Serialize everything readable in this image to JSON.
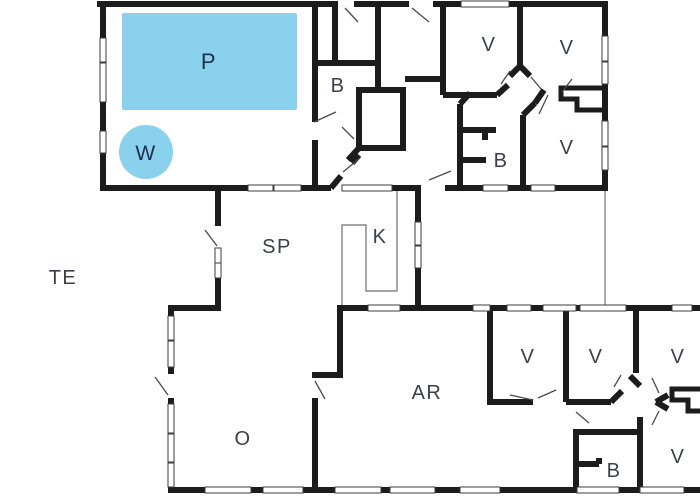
{
  "plan": {
    "title": "Holiday house floor plan",
    "background": "#ffffff",
    "wall_color": "#1c1c1c",
    "window_stroke": "#3c3c3c",
    "door_stroke": "#4a4a4a",
    "thin_stroke": "#6f6f6f",
    "pool_color": "#8ad1ee",
    "label_color": "#3a3f4a",
    "pool_label_color": "#203050"
  },
  "rooms": [
    {
      "id": "pool",
      "label": "P",
      "x": 209,
      "y": 69,
      "size": 22,
      "color_key": "pool_label_color"
    },
    {
      "id": "whirlpool",
      "label": "W",
      "x": 146,
      "y": 160,
      "size": 21,
      "color_key": "pool_label_color"
    },
    {
      "id": "bathroom-top",
      "label": "B",
      "x": 338,
      "y": 92,
      "size": 20
    },
    {
      "id": "bedroom-1",
      "label": "V",
      "x": 489,
      "y": 51,
      "size": 20
    },
    {
      "id": "bedroom-2",
      "label": "V",
      "x": 567,
      "y": 54,
      "size": 20
    },
    {
      "id": "bathroom-east",
      "label": "B",
      "x": 501,
      "y": 167,
      "size": 20
    },
    {
      "id": "bedroom-3",
      "label": "V",
      "x": 567,
      "y": 154,
      "size": 20
    },
    {
      "id": "terrace",
      "label": "TE",
      "x": 63,
      "y": 284,
      "size": 20
    },
    {
      "id": "hallway",
      "label": "SP",
      "x": 277,
      "y": 253,
      "size": 20
    },
    {
      "id": "kitchen",
      "label": "K",
      "x": 380,
      "y": 243,
      "size": 20
    },
    {
      "id": "living-room",
      "label": "O",
      "x": 243,
      "y": 445,
      "size": 20
    },
    {
      "id": "activity-room",
      "label": "AR",
      "x": 427,
      "y": 399,
      "size": 20
    },
    {
      "id": "bedroom-4",
      "label": "V",
      "x": 528,
      "y": 363,
      "size": 20
    },
    {
      "id": "bedroom-5",
      "label": "V",
      "x": 596,
      "y": 363,
      "size": 20
    },
    {
      "id": "bedroom-6",
      "label": "V",
      "x": 678,
      "y": 363,
      "size": 20
    },
    {
      "id": "bathroom-south",
      "label": "B",
      "x": 614,
      "y": 477,
      "size": 20
    },
    {
      "id": "bedroom-7",
      "label": "V",
      "x": 678,
      "y": 463,
      "size": 20
    }
  ]
}
